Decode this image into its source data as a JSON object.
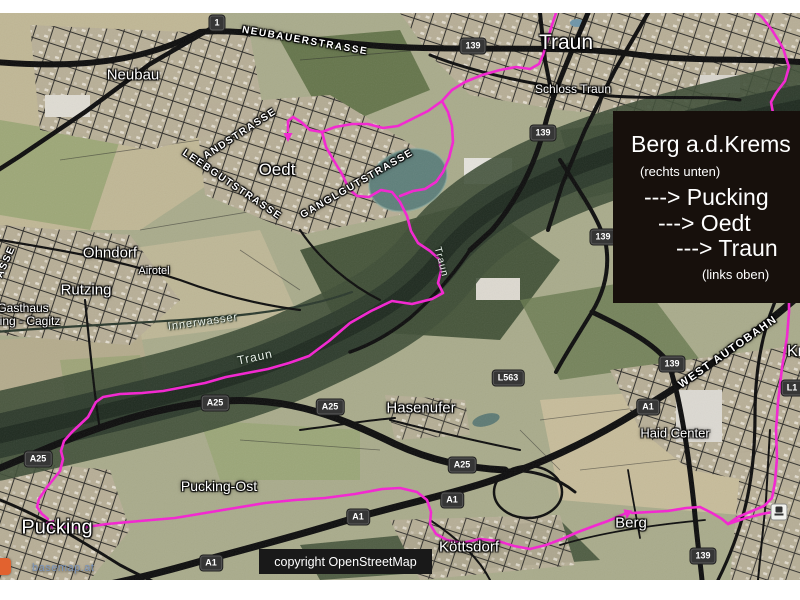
{
  "page": {
    "background": "#ffffff"
  },
  "map": {
    "info_box": {
      "title": "Berg a.d.Krems",
      "note_top": "(rechts unten)",
      "route_lines": [
        "---> Pucking",
        "---> Oedt",
        "---> Traun"
      ],
      "note_bottom": "(links oben)",
      "background": "#17100c",
      "text_color": "#ffffff"
    },
    "attribution_box": {
      "label": "copyright OpenStreetMap"
    },
    "watermark": {
      "label": "basemap.at",
      "color": "#7d97bd",
      "logo_color": "#e2622f"
    },
    "place_labels": [
      {
        "text": "Neubau",
        "x": 133,
        "y": 75,
        "size": 15
      },
      {
        "text": "Traun",
        "x": 566,
        "y": 43,
        "size": 21
      },
      {
        "text": "Schloss Traun",
        "x": 573,
        "y": 89,
        "size": 12
      },
      {
        "text": "Oedt",
        "x": 277,
        "y": 170,
        "size": 17
      },
      {
        "text": "Ohndorf",
        "x": 110,
        "y": 253,
        "size": 15
      },
      {
        "text": "Airotel",
        "x": 154,
        "y": 271,
        "size": 11
      },
      {
        "text": "Rutzing",
        "x": 86,
        "y": 290,
        "size": 15
      },
      {
        "text": "Gasthaus",
        "x": 23,
        "y": 308,
        "size": 12
      },
      {
        "text": "zing - Cagitz",
        "x": 27,
        "y": 321,
        "size": 12
      },
      {
        "text": "Hasenufer",
        "x": 421,
        "y": 408,
        "size": 15
      },
      {
        "text": "Pucking-Ost",
        "x": 219,
        "y": 486,
        "size": 14
      },
      {
        "text": "Pucking",
        "x": 57,
        "y": 528,
        "size": 20
      },
      {
        "text": "Köttsdorf",
        "x": 469,
        "y": 547,
        "size": 15
      },
      {
        "text": "Berg",
        "x": 631,
        "y": 523,
        "size": 15
      },
      {
        "text": "Haid Center",
        "x": 675,
        "y": 433,
        "size": 13
      },
      {
        "text": "Kr",
        "x": 795,
        "y": 352,
        "size": 16
      }
    ],
    "road_labels": [
      {
        "text": "NEUBAUERSTRASSE",
        "x": 305,
        "y": 41,
        "rot": 10
      },
      {
        "text": "LANDSTRASSE",
        "x": 237,
        "y": 136,
        "rot": -33
      },
      {
        "text": "LEEBGUTSTRASSE",
        "x": 232,
        "y": 185,
        "rot": 34
      },
      {
        "text": "GANGLGUTSTRASSE",
        "x": 357,
        "y": 184,
        "rot": -30
      },
      {
        "text": "WEST AUTOBAHN",
        "x": 728,
        "y": 352,
        "rot": -35,
        "size": 11
      },
      {
        "text": "ASSE",
        "x": 6,
        "y": 262,
        "rot": -66
      }
    ],
    "water_labels": [
      {
        "text": "Innerwasser",
        "x": 203,
        "y": 322,
        "rot": -8,
        "size": 11
      },
      {
        "text": "Traun",
        "x": 255,
        "y": 357,
        "rot": -12,
        "size": 12
      },
      {
        "text": "Traun",
        "x": 441,
        "y": 262,
        "rot": 75,
        "size": 10
      }
    ],
    "shields": [
      {
        "text": "1",
        "x": 217,
        "y": 23
      },
      {
        "text": "139",
        "x": 473,
        "y": 46
      },
      {
        "text": "139",
        "x": 543,
        "y": 133
      },
      {
        "text": "139",
        "x": 603,
        "y": 237
      },
      {
        "text": "139",
        "x": 672,
        "y": 364
      },
      {
        "text": "139",
        "x": 703,
        "y": 556
      },
      {
        "text": "A25",
        "x": 215,
        "y": 403
      },
      {
        "text": "A25",
        "x": 330,
        "y": 407
      },
      {
        "text": "A25",
        "x": 38,
        "y": 459
      },
      {
        "text": "A25",
        "x": 462,
        "y": 465
      },
      {
        "text": "A1",
        "x": 648,
        "y": 407
      },
      {
        "text": "A1",
        "x": 452,
        "y": 500
      },
      {
        "text": "A1",
        "x": 358,
        "y": 517
      },
      {
        "text": "A1",
        "x": 211,
        "y": 563
      },
      {
        "text": "L563",
        "x": 508,
        "y": 378
      },
      {
        "text": "L1",
        "x": 792,
        "y": 388
      }
    ],
    "station_icon": {
      "x": 779,
      "y": 512
    },
    "route": {
      "color": "#f522d2",
      "width": 2.6,
      "paths": [
        {
          "name": "oedt-to-traun",
          "points": [
            [
              288,
              131
            ],
            [
              288,
              121
            ],
            [
              293,
              117
            ],
            [
              301,
              122
            ],
            [
              310,
              130
            ],
            [
              322,
              132
            ],
            [
              335,
              127
            ],
            [
              352,
              124
            ],
            [
              368,
              124
            ],
            [
              383,
              128
            ],
            [
              398,
              126
            ],
            [
              412,
              119
            ],
            [
              428,
              111
            ],
            [
              442,
              101
            ],
            [
              452,
              90
            ],
            [
              465,
              82
            ],
            [
              482,
              75
            ],
            [
              500,
              70
            ],
            [
              516,
              67
            ],
            [
              530,
              69
            ],
            [
              539,
              64
            ],
            [
              543,
              55
            ],
            [
              548,
              38
            ],
            [
              552,
              25
            ],
            [
              556,
              13
            ]
          ]
        },
        {
          "name": "oedt-lake-loop",
          "points": [
            [
              442,
              101
            ],
            [
              448,
              112
            ],
            [
              452,
              126
            ],
            [
              453,
              142
            ],
            [
              449,
              158
            ],
            [
              443,
              172
            ],
            [
              436,
              182
            ],
            [
              425,
              189
            ],
            [
              413,
              191
            ],
            [
              400,
              196
            ]
          ]
        },
        {
          "name": "oedt-to-river-to-pucking",
          "points": [
            [
              322,
              132
            ],
            [
              326,
              147
            ],
            [
              334,
              161
            ],
            [
              342,
              174
            ],
            [
              349,
              189
            ],
            [
              357,
              196
            ],
            [
              369,
              197
            ],
            [
              381,
              190
            ],
            [
              392,
              192
            ],
            [
              400,
              202
            ],
            [
              407,
              216
            ],
            [
              411,
              231
            ],
            [
              418,
              243
            ],
            [
              430,
              251
            ],
            [
              439,
              259
            ],
            [
              441,
              271
            ],
            [
              438,
              283
            ],
            [
              443,
              293
            ],
            [
              432,
              299
            ],
            [
              412,
              304
            ],
            [
              392,
              301
            ],
            [
              371,
              311
            ],
            [
              350,
              323
            ],
            [
              329,
              341
            ],
            [
              309,
              356
            ],
            [
              289,
              363
            ],
            [
              268,
              369
            ],
            [
              247,
              373
            ],
            [
              226,
              377
            ],
            [
              205,
              383
            ],
            [
              184,
              387
            ],
            [
              163,
              391
            ],
            [
              142,
              393
            ],
            [
              120,
              394
            ],
            [
              103,
              397
            ],
            [
              96,
              402
            ],
            [
              88,
              417
            ],
            [
              72,
              432
            ],
            [
              64,
              441
            ],
            [
              61,
              451
            ],
            [
              63,
              459
            ],
            [
              60,
              471
            ],
            [
              52,
              481
            ],
            [
              47,
              487
            ],
            [
              39,
              499
            ],
            [
              37,
              507
            ],
            [
              42,
              514
            ],
            [
              48,
              519
            ]
          ]
        },
        {
          "name": "pucking-to-berg",
          "points": [
            [
              56,
              526
            ],
            [
              80,
              528
            ],
            [
              107,
              524
            ],
            [
              140,
              521
            ],
            [
              175,
              518
            ],
            [
              205,
              513
            ],
            [
              235,
              508
            ],
            [
              265,
              503
            ],
            [
              295,
              500
            ],
            [
              325,
              498
            ],
            [
              355,
              494
            ],
            [
              382,
              489
            ],
            [
              400,
              488
            ],
            [
              417,
              492
            ],
            [
              427,
              500
            ],
            [
              431,
              512
            ],
            [
              430,
              524
            ],
            [
              436,
              534
            ],
            [
              447,
              540
            ],
            [
              462,
              543
            ],
            [
              480,
              539
            ],
            [
              498,
              541
            ],
            [
              514,
              546
            ],
            [
              530,
              549
            ],
            [
              546,
              545
            ],
            [
              562,
              539
            ],
            [
              578,
              532
            ],
            [
              594,
              526
            ],
            [
              608,
              521
            ],
            [
              622,
              515
            ],
            [
              628,
              512
            ]
          ]
        },
        {
          "name": "berg-east",
          "points": [
            [
              632,
              513
            ],
            [
              650,
              512
            ],
            [
              668,
              511
            ],
            [
              686,
              508
            ],
            [
              700,
              507
            ]
          ]
        },
        {
          "name": "east-edge-climb",
          "points": [
            [
              700,
              507
            ],
            [
              712,
              513
            ],
            [
              722,
              519
            ],
            [
              728,
              524
            ],
            [
              738,
              517
            ],
            [
              752,
              511
            ],
            [
              764,
              506
            ],
            [
              772,
              498
            ],
            [
              775,
              482
            ],
            [
              777,
              458
            ],
            [
              776,
              430
            ],
            [
              778,
              402
            ],
            [
              782,
              368
            ],
            [
              787,
              337
            ],
            [
              789,
              312
            ],
            [
              789,
              280
            ],
            [
              786,
              240
            ],
            [
              782,
              200
            ],
            [
              779,
              160
            ],
            [
              776,
              130
            ],
            [
              773,
              113
            ],
            [
              771,
              102
            ],
            [
              776,
              93
            ],
            [
              785,
              81
            ],
            [
              789,
              67
            ],
            [
              783,
              48
            ],
            [
              772,
              30
            ],
            [
              762,
              17
            ],
            [
              757,
              13
            ]
          ]
        },
        {
          "name": "station-spur",
          "points": [
            [
              728,
              524
            ],
            [
              746,
              518
            ],
            [
              762,
              514
            ],
            [
              773,
              512
            ]
          ]
        }
      ],
      "arrows": [
        {
          "label": "oedt-endpoint",
          "x": 288,
          "y": 133,
          "angle": 90
        },
        {
          "label": "pucking-arrival",
          "x": 50,
          "y": 521,
          "angle": 75
        },
        {
          "label": "berg-arrival",
          "x": 628,
          "y": 510,
          "angle": 98
        }
      ]
    }
  }
}
